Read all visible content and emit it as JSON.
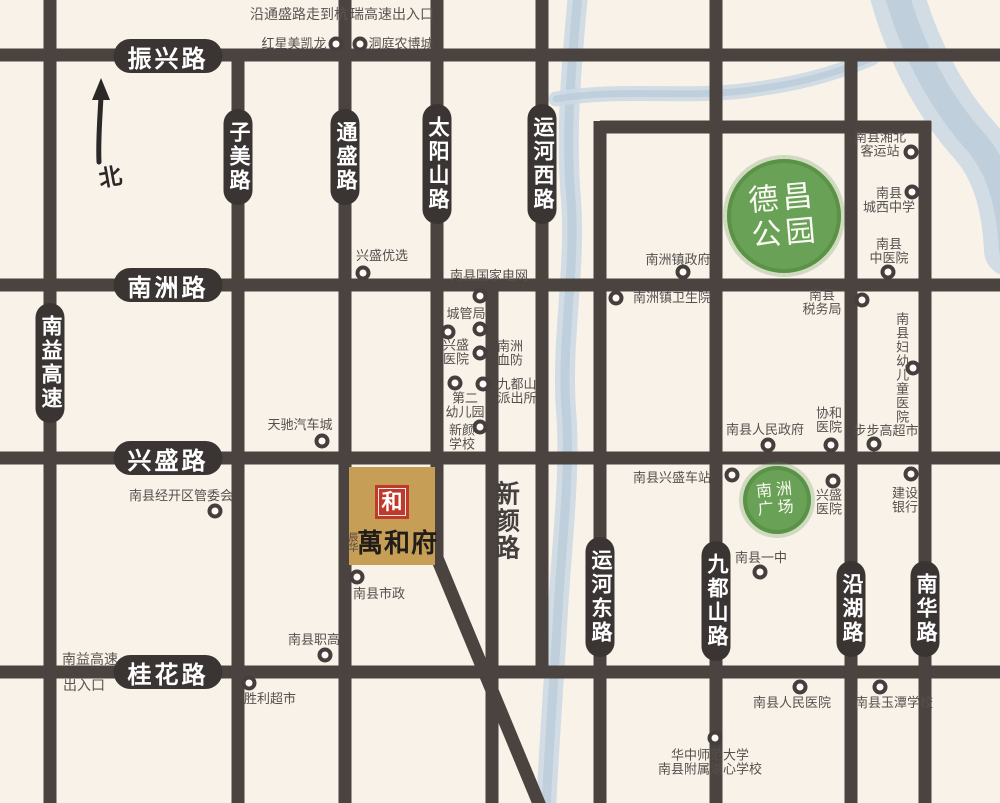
{
  "map": {
    "north_label": "北",
    "colors": {
      "background": "#f8f2e9",
      "road": "#4a4340",
      "pill": "#3a3433",
      "river_base": "#ccd9e4",
      "river_core": "#b7c8d7",
      "park_green": "#69a157",
      "poi_text": "#55504d",
      "property_gold": "#c79e55",
      "seal_red": "#bf3a2b"
    },
    "property": {
      "name": "萬和府",
      "prefix": "辰华",
      "seal_char": "和"
    },
    "parks": [
      {
        "name": "德昌公园",
        "lines": "德昌\n公园",
        "cx": 784,
        "cy": 216,
        "r": 57,
        "font": 30
      },
      {
        "name": "南洲广场",
        "lines": "南洲\n广场",
        "cx": 777,
        "cy": 500,
        "r": 34,
        "font": 16
      }
    ],
    "roads": [
      {
        "id": "zhenxing-road",
        "label": "振兴路",
        "x1": 0,
        "y1": 55,
        "x2": 1000,
        "y2": 55,
        "pill": {
          "x": 168,
          "y": 56,
          "dir": "h"
        }
      },
      {
        "id": "nanzhou-road",
        "label": "南洲路",
        "x1": 0,
        "y1": 285,
        "x2": 1000,
        "y2": 285,
        "pill": {
          "x": 168,
          "y": 285,
          "dir": "h"
        }
      },
      {
        "id": "xingsheng-road",
        "label": "兴盛路",
        "x1": 0,
        "y1": 458,
        "x2": 1000,
        "y2": 458,
        "pill": {
          "x": 168,
          "y": 458,
          "dir": "h"
        }
      },
      {
        "id": "guihua-road",
        "label": "桂花路",
        "x1": 0,
        "y1": 672,
        "x2": 1000,
        "y2": 672,
        "pill": {
          "x": 168,
          "y": 672,
          "dir": "h"
        }
      },
      {
        "id": "loop-north-road",
        "label": "",
        "x1": 600,
        "y1": 127,
        "x2": 931,
        "y2": 127
      },
      {
        "id": "nanyi-expressway",
        "label": "南益高速",
        "x1": 50,
        "y1": 0,
        "x2": 50,
        "y2": 803,
        "pill": {
          "x": 50,
          "y": 363,
          "dir": "v"
        }
      },
      {
        "id": "zimei-road",
        "label": "子美路",
        "x1": 238,
        "y1": 49,
        "x2": 238,
        "y2": 803,
        "pill": {
          "x": 238,
          "y": 157,
          "dir": "v"
        }
      },
      {
        "id": "tongsheng-road",
        "label": "通盛路",
        "x1": 345,
        "y1": 0,
        "x2": 345,
        "y2": 803,
        "pill": {
          "x": 345,
          "y": 157,
          "dir": "v"
        }
      },
      {
        "id": "taiyangshan-road",
        "label": "太阳山路",
        "x1": 437,
        "y1": 0,
        "x2": 437,
        "y2": 562,
        "pill": {
          "x": 437,
          "y": 164,
          "dir": "v"
        }
      },
      {
        "id": "taiyangshan-diagonal",
        "label": "",
        "x1": 437,
        "y1": 558,
        "x2": 540,
        "y2": 806
      },
      {
        "id": "xinyan-road",
        "label": "",
        "x1": 492,
        "y1": 279,
        "x2": 492,
        "y2": 803
      },
      {
        "id": "yunhe-west-road",
        "label": "运河西路",
        "x1": 542,
        "y1": 0,
        "x2": 542,
        "y2": 678,
        "pill": {
          "x": 542,
          "y": 164,
          "dir": "v"
        }
      },
      {
        "id": "yunhe-east-road",
        "label": "运河东路",
        "x1": 600,
        "y1": 121,
        "x2": 600,
        "y2": 803,
        "pill": {
          "x": 600,
          "y": 597,
          "dir": "v"
        }
      },
      {
        "id": "jiudushan-road",
        "label": "九都山路",
        "x1": 716,
        "y1": 0,
        "x2": 716,
        "y2": 803,
        "pill": {
          "x": 716,
          "y": 601,
          "dir": "v"
        }
      },
      {
        "id": "yanhu-road",
        "label": "沿湖路",
        "x1": 851,
        "y1": 49,
        "x2": 851,
        "y2": 803,
        "pill": {
          "x": 851,
          "y": 609,
          "dir": "v"
        }
      },
      {
        "id": "nanhua-road",
        "label": "南华路",
        "x1": 925,
        "y1": 121,
        "x2": 925,
        "y2": 803,
        "pill": {
          "x": 925,
          "y": 609,
          "dir": "v"
        }
      }
    ],
    "rivers": [
      {
        "id": "canal-stream",
        "path": "M578,-6 C572,60 565,130 571,200 C576,270 561,340 566,410 C571,470 562,540 558,610 C554,680 549,745 546,810",
        "width": 20
      },
      {
        "id": "north-stream",
        "path": "M556,99 C620,88 682,98 742,91 C792,85 830,76 872,58",
        "width": 15
      },
      {
        "id": "river-band",
        "path": "M892,-25 C908,45 940,102 974,140 C998,166 1009,205 1011,250",
        "width": 54
      }
    ],
    "notes": [
      {
        "text": "沿通盛路走到杭",
        "x": 299,
        "y": 14
      },
      {
        "text": "瑞高速出入口",
        "x": 392,
        "y": 14
      },
      {
        "text": "南益高速",
        "x": 90,
        "y": 659
      },
      {
        "text": "出入口",
        "x": 84,
        "y": 685
      },
      {
        "text": "新颜路",
        "x": 505,
        "y": 521,
        "cls": "road-name"
      }
    ],
    "pois": [
      {
        "label": "红星美凯龙",
        "dot": [
          336,
          44
        ],
        "text": [
          294,
          44
        ]
      },
      {
        "label": "洞庭农博城",
        "dot": [
          360,
          44
        ],
        "text": [
          401,
          44
        ]
      },
      {
        "label": "兴盛优选",
        "dot": [
          363,
          273
        ],
        "text": [
          382,
          256
        ]
      },
      {
        "label": "南县国家电网",
        "dot": [
          480,
          296
        ],
        "text": [
          489,
          276
        ]
      },
      {
        "label": "城管局",
        "dot": [
          480,
          329
        ],
        "text": [
          466,
          314
        ]
      },
      {
        "label": "兴盛医院",
        "dot": [
          448,
          332
        ],
        "text": [
          456,
          353
        ],
        "lines": "兴盛\n医院"
      },
      {
        "label": "南洲血防",
        "dot": [
          480,
          353
        ],
        "text": [
          510,
          354
        ],
        "lines": "南洲\n血防"
      },
      {
        "label": "第二幼儿园",
        "dot": [
          455,
          383
        ],
        "text": [
          465,
          406
        ],
        "lines": "第二\n幼儿园"
      },
      {
        "label": "九都山派出所",
        "dot": [
          483,
          384
        ],
        "text": [
          517,
          392
        ],
        "lines": "九都山\n派出所"
      },
      {
        "label": "新颜学校",
        "dot": [
          480,
          427
        ],
        "text": [
          462,
          438
        ],
        "lines": "新颜\n学校"
      },
      {
        "label": "天驰汽车城",
        "dot": [
          322,
          441
        ],
        "text": [
          300,
          425
        ]
      },
      {
        "label": "南县经开区管委会",
        "dot": [
          215,
          511
        ],
        "text": [
          181,
          496
        ]
      },
      {
        "label": "南县市政",
        "dot": [
          357,
          577
        ],
        "text": [
          379,
          594
        ]
      },
      {
        "label": "南县职高",
        "dot": [
          325,
          655
        ],
        "text": [
          314,
          640
        ]
      },
      {
        "label": "胜利超市",
        "dot": [
          249,
          683
        ],
        "text": [
          270,
          699
        ]
      },
      {
        "label": "南洲镇政府",
        "dot": [
          683,
          272
        ],
        "text": [
          678,
          260
        ]
      },
      {
        "label": "南洲镇卫生院",
        "dot": [
          616,
          298
        ],
        "text": [
          672,
          298
        ]
      },
      {
        "label": "南县湘北客运站",
        "dot": [
          911,
          152
        ],
        "text": [
          880,
          145
        ],
        "lines": "南县湘北\n客运站"
      },
      {
        "label": "南县城西中学",
        "dot": [
          912,
          192
        ],
        "text": [
          889,
          201
        ],
        "lines": "南县\n城西中学"
      },
      {
        "label": "南县中医院",
        "dot": [
          888,
          272
        ],
        "text": [
          889,
          252
        ],
        "lines": "南县\n中医院"
      },
      {
        "label": "南县税务局",
        "dot": [
          862,
          300
        ],
        "text": [
          822,
          303
        ],
        "lines": "南县\n税务局"
      },
      {
        "label": "南县妇幼儿童医院",
        "dot": [
          913,
          368
        ],
        "text": [
          901,
          368
        ],
        "vertical": true
      },
      {
        "label": "南县人民政府",
        "dot": [
          768,
          445
        ],
        "text": [
          765,
          430
        ]
      },
      {
        "label": "协和医院",
        "dot": [
          831,
          445
        ],
        "text": [
          829,
          421
        ],
        "lines": "协和\n医院"
      },
      {
        "label": "步步高超市",
        "dot": [
          874,
          444
        ],
        "text": [
          886,
          431
        ]
      },
      {
        "label": "南县兴盛车站",
        "dot": [
          732,
          475
        ],
        "text": [
          672,
          478
        ]
      },
      {
        "label": "兴盛医院",
        "dot": [
          833,
          481
        ],
        "text": [
          829,
          503
        ],
        "lines": "兴盛\n医院"
      },
      {
        "label": "建设银行",
        "dot": [
          911,
          474
        ],
        "text": [
          905,
          501
        ],
        "lines": "建设\n银行"
      },
      {
        "label": "南县一中",
        "dot": [
          760,
          572
        ],
        "text": [
          761,
          558
        ]
      },
      {
        "label": "南县人民医院",
        "dot": [
          800,
          687
        ],
        "text": [
          792,
          703
        ]
      },
      {
        "label": "南县玉潭学校",
        "dot": [
          880,
          687
        ],
        "text": [
          894,
          703
        ]
      },
      {
        "label": "华中师范大学南县附属湖心学校",
        "dot": [
          715,
          738
        ],
        "text": [
          710,
          763
        ],
        "lines": "华中师范大学\n南县附属湖心学校"
      }
    ]
  }
}
